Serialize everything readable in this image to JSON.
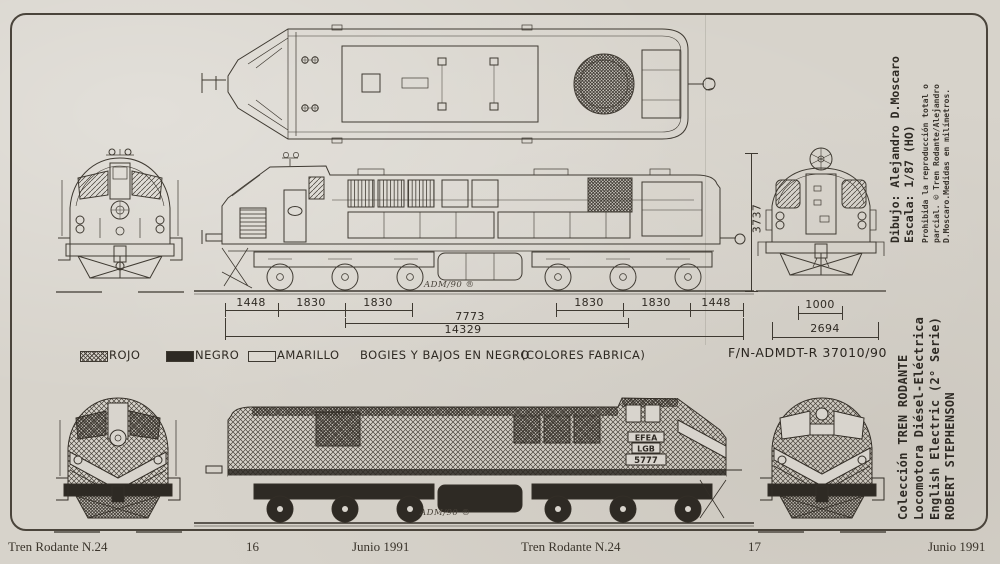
{
  "dimensions": {
    "left_chain": [
      "1448",
      "1830",
      "1830"
    ],
    "right_chain": [
      "1830",
      "1830",
      "1448"
    ],
    "bogie_distance": "7773",
    "total_length": "14329",
    "height": "3737",
    "gauge": "1000",
    "width": "2694"
  },
  "legend": {
    "rojo": "ROJO",
    "negro": "NEGRO",
    "amarillo": "AMARILLO",
    "note_bogies": "BOGIES Y BAJOS EN NEGRO",
    "note_colores": "(COLORES FABRICA)",
    "reference": "F/N-ADMDT-R  37010/90"
  },
  "markings": {
    "signature_top": "ADM/90 ®",
    "signature_bottom": "ADM/90 ®",
    "cab_plate": [
      "EFEA",
      "LGB",
      "5777"
    ]
  },
  "margin_top": {
    "line1": "Dibujo: Alejandro D.Moscaro",
    "line2": "Escala: 1/87 (HO)",
    "legal1": "Prohibida la reproducción total o",
    "legal2": "parcial. © Tren Rodante/Alejandro",
    "legal3": "D.Moscaro.Medidas en milímetros."
  },
  "margin_bottom": {
    "line1": "Colección TREN RODANTE",
    "line2": "Locomotora Diésel-Eléctrica",
    "line3": "English Electric (2° Serie)",
    "line4": "ROBERT  STEPHENSON"
  },
  "footer_left": {
    "title": "Tren Rodante N.24",
    "page": "16",
    "date": "Junio 1991"
  },
  "footer_right": {
    "title": "Tren Rodante N.24",
    "page": "17",
    "date": "Junio 1991"
  }
}
